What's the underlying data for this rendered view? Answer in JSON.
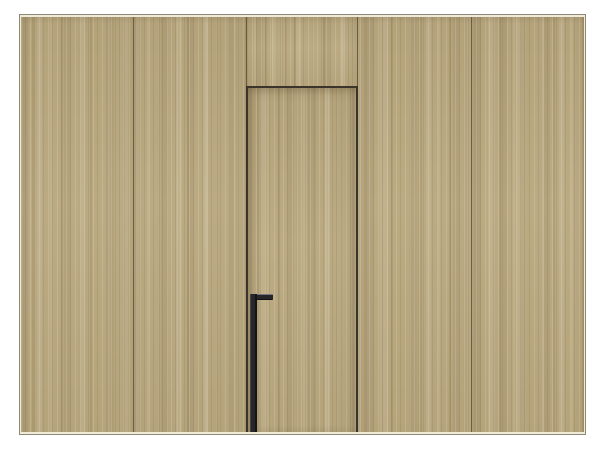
{
  "scene": {
    "type": "interior-render",
    "subject": "wood-veneer paneled wall with concealed flush door and tall black pull handle"
  },
  "colors": {
    "background": "#ffffff",
    "wood_base": "#b9a87f",
    "wood_light": "#cdbf9b",
    "wood_dark": "#a08e66",
    "panel_seam": "#6e5f41",
    "door_outline": "#3a342b",
    "handle": "#26262a",
    "handle_highlight": "#74747c",
    "frame_edge": "#8e8876",
    "inner_edge": "#f0ead9"
  },
  "layout": {
    "panel_count": 5,
    "door_bay_index": 3,
    "has_transom_panel": true,
    "handle_side": "left"
  }
}
